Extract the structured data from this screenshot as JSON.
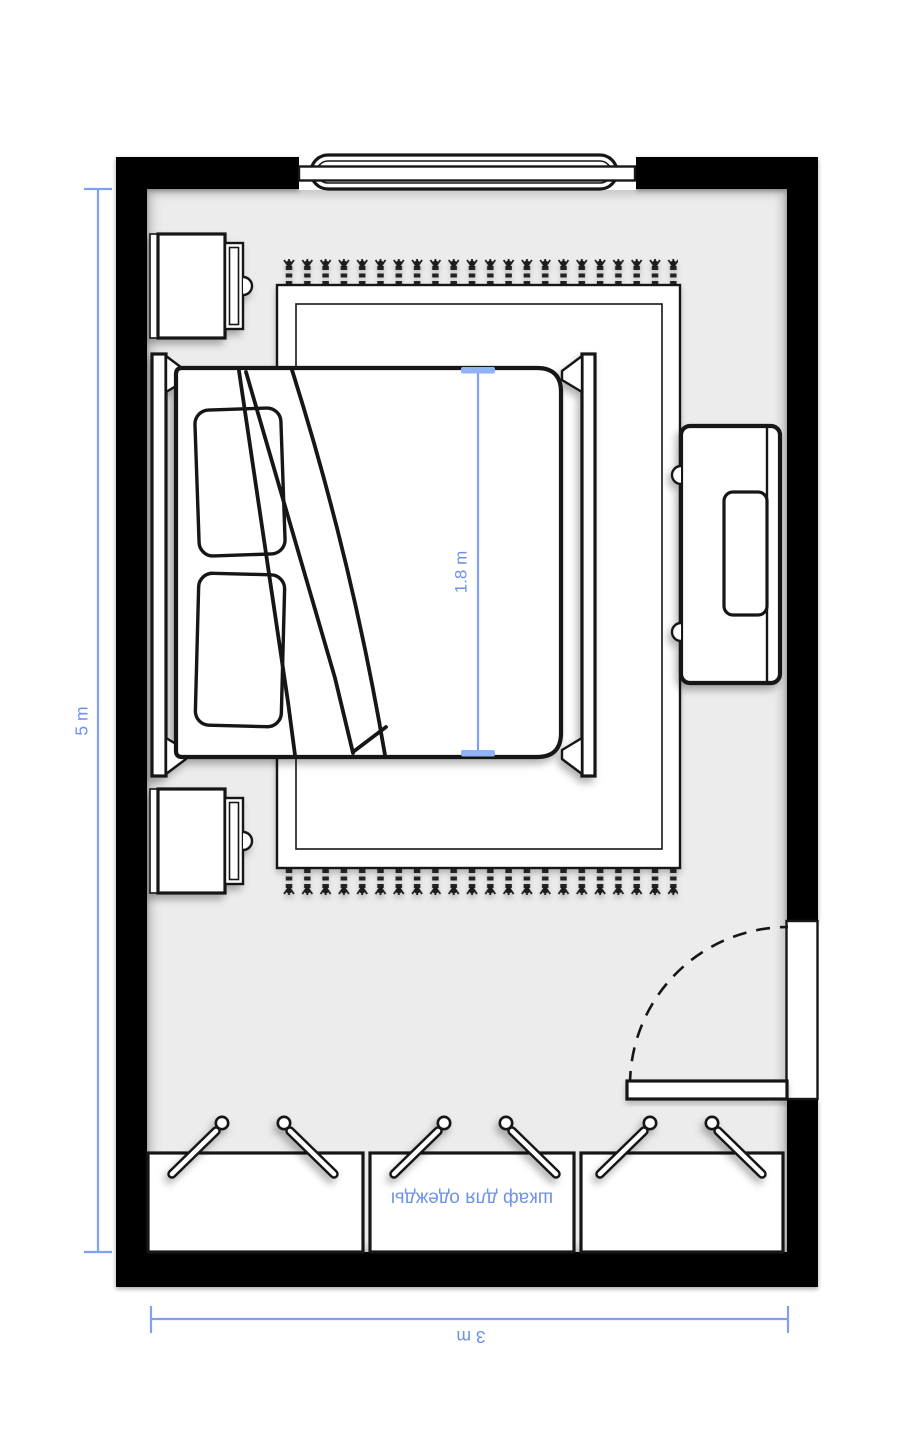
{
  "plan_title": "bedroom-floor-plan",
  "dimensions": {
    "room_height": {
      "label": "5 m"
    },
    "room_width": {
      "label": "3 m"
    },
    "bed_width": {
      "label": "1.8 m"
    }
  },
  "furniture": {
    "wardrobe": {
      "label": "шкаф для одежды"
    }
  },
  "colors": {
    "wall": "#000000",
    "floor": "#ececec",
    "furniture_fill": "#ffffff",
    "outline": "#161616",
    "dimension_line": "#7fa1ef",
    "dimension_tick": "#8fb3f6",
    "dimension_text": "#6d91e6",
    "wardrobe_text": "#7093e8"
  }
}
